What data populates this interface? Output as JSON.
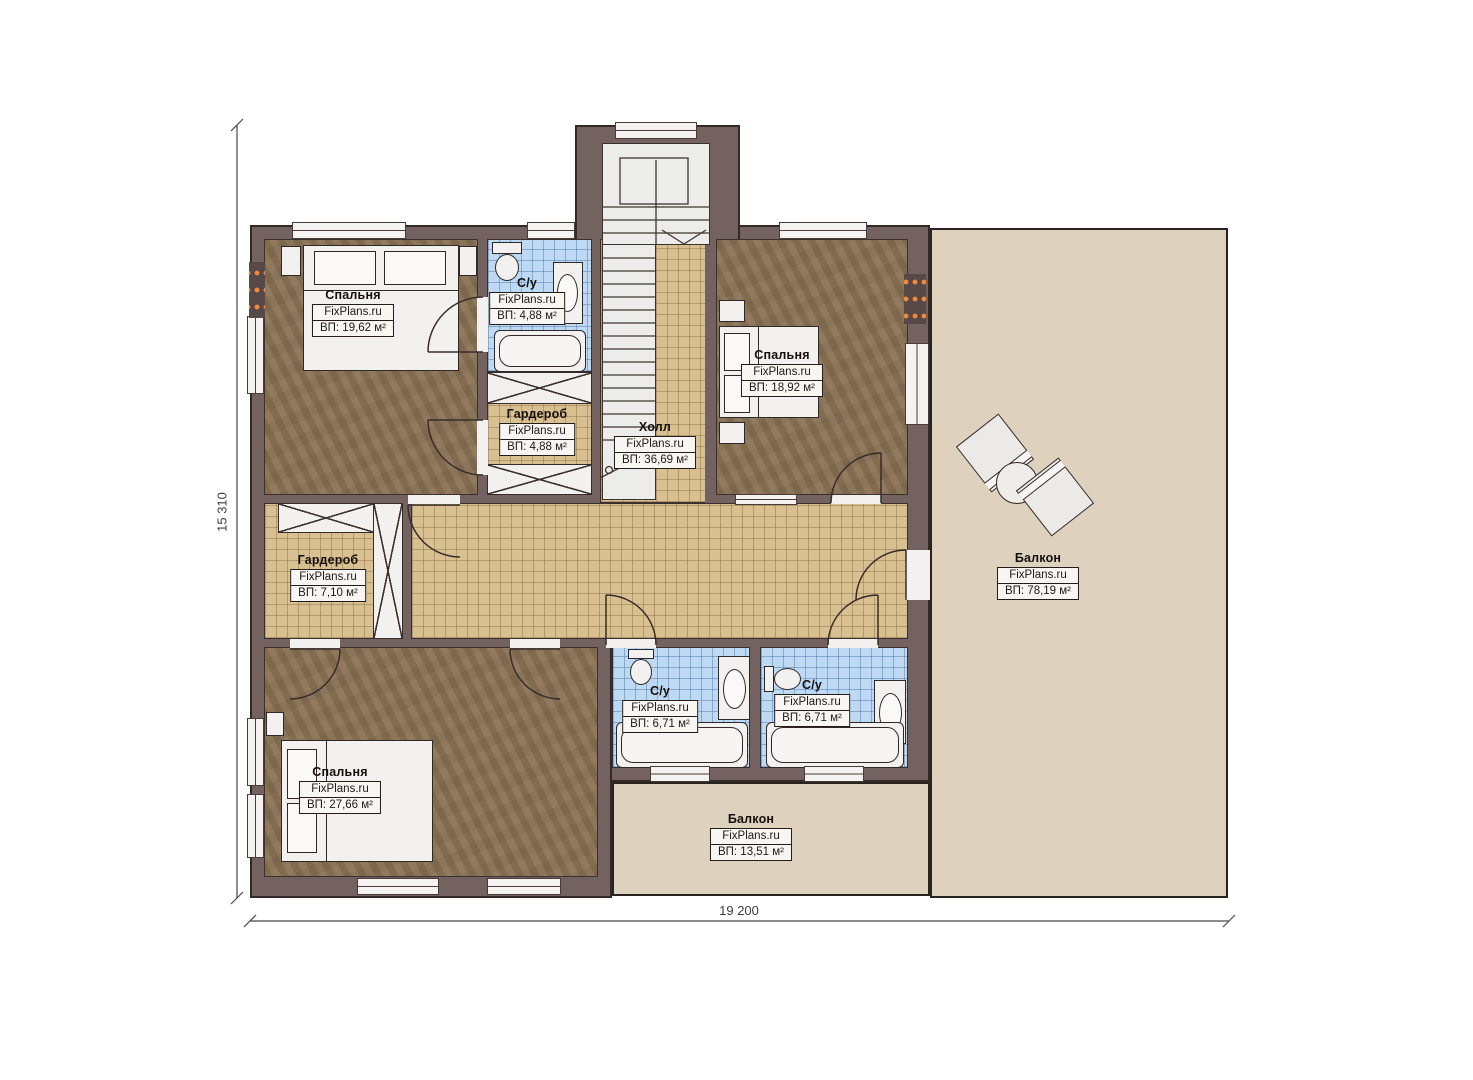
{
  "plan": {
    "watermark": "FixPlans.ru",
    "dimensions": {
      "width_label": "19 200",
      "height_label": "15 310"
    },
    "colors": {
      "wall": "#746260",
      "bedroom_floor": "#8b7355",
      "hall_tile": "#d9c091",
      "bathroom_tile": "#bdd9f4",
      "balcony_floor": "#ded2be",
      "radiator_accent": "#f5883b"
    },
    "rooms": [
      {
        "id": "bedroom-top-left",
        "name": "Спальня",
        "brand": "FixPlans.ru",
        "area": "ВП: 19,62 м²"
      },
      {
        "id": "bathroom-top",
        "name": "С/у",
        "brand": "FixPlans.ru",
        "area": "ВП: 4,88 м²"
      },
      {
        "id": "wardrobe-top",
        "name": "Гардероб",
        "brand": "FixPlans.ru",
        "area": "ВП: 4,88 м²"
      },
      {
        "id": "hall",
        "name": "Холл",
        "brand": "FixPlans.ru",
        "area": "ВП: 36,69 м²"
      },
      {
        "id": "bedroom-top-right",
        "name": "Спальня",
        "brand": "FixPlans.ru",
        "area": "ВП: 18,92 м²"
      },
      {
        "id": "wardrobe-left",
        "name": "Гардероб",
        "brand": "FixPlans.ru",
        "area": "ВП: 7,10 м²"
      },
      {
        "id": "balcony-right",
        "name": "Балкон",
        "brand": "FixPlans.ru",
        "area": "ВП: 78,19 м²"
      },
      {
        "id": "bedroom-bottom-left",
        "name": "Спальня",
        "brand": "FixPlans.ru",
        "area": "ВП: 27,66 м²"
      },
      {
        "id": "bathroom-bottom-left",
        "name": "С/у",
        "brand": "FixPlans.ru",
        "area": "ВП: 6,71 м²"
      },
      {
        "id": "bathroom-bottom-right",
        "name": "С/у",
        "brand": "FixPlans.ru",
        "area": "ВП: 6,71 м²"
      },
      {
        "id": "balcony-bottom",
        "name": "Балкон",
        "brand": "FixPlans.ru",
        "area": "ВП: 13,51 м²"
      }
    ]
  }
}
